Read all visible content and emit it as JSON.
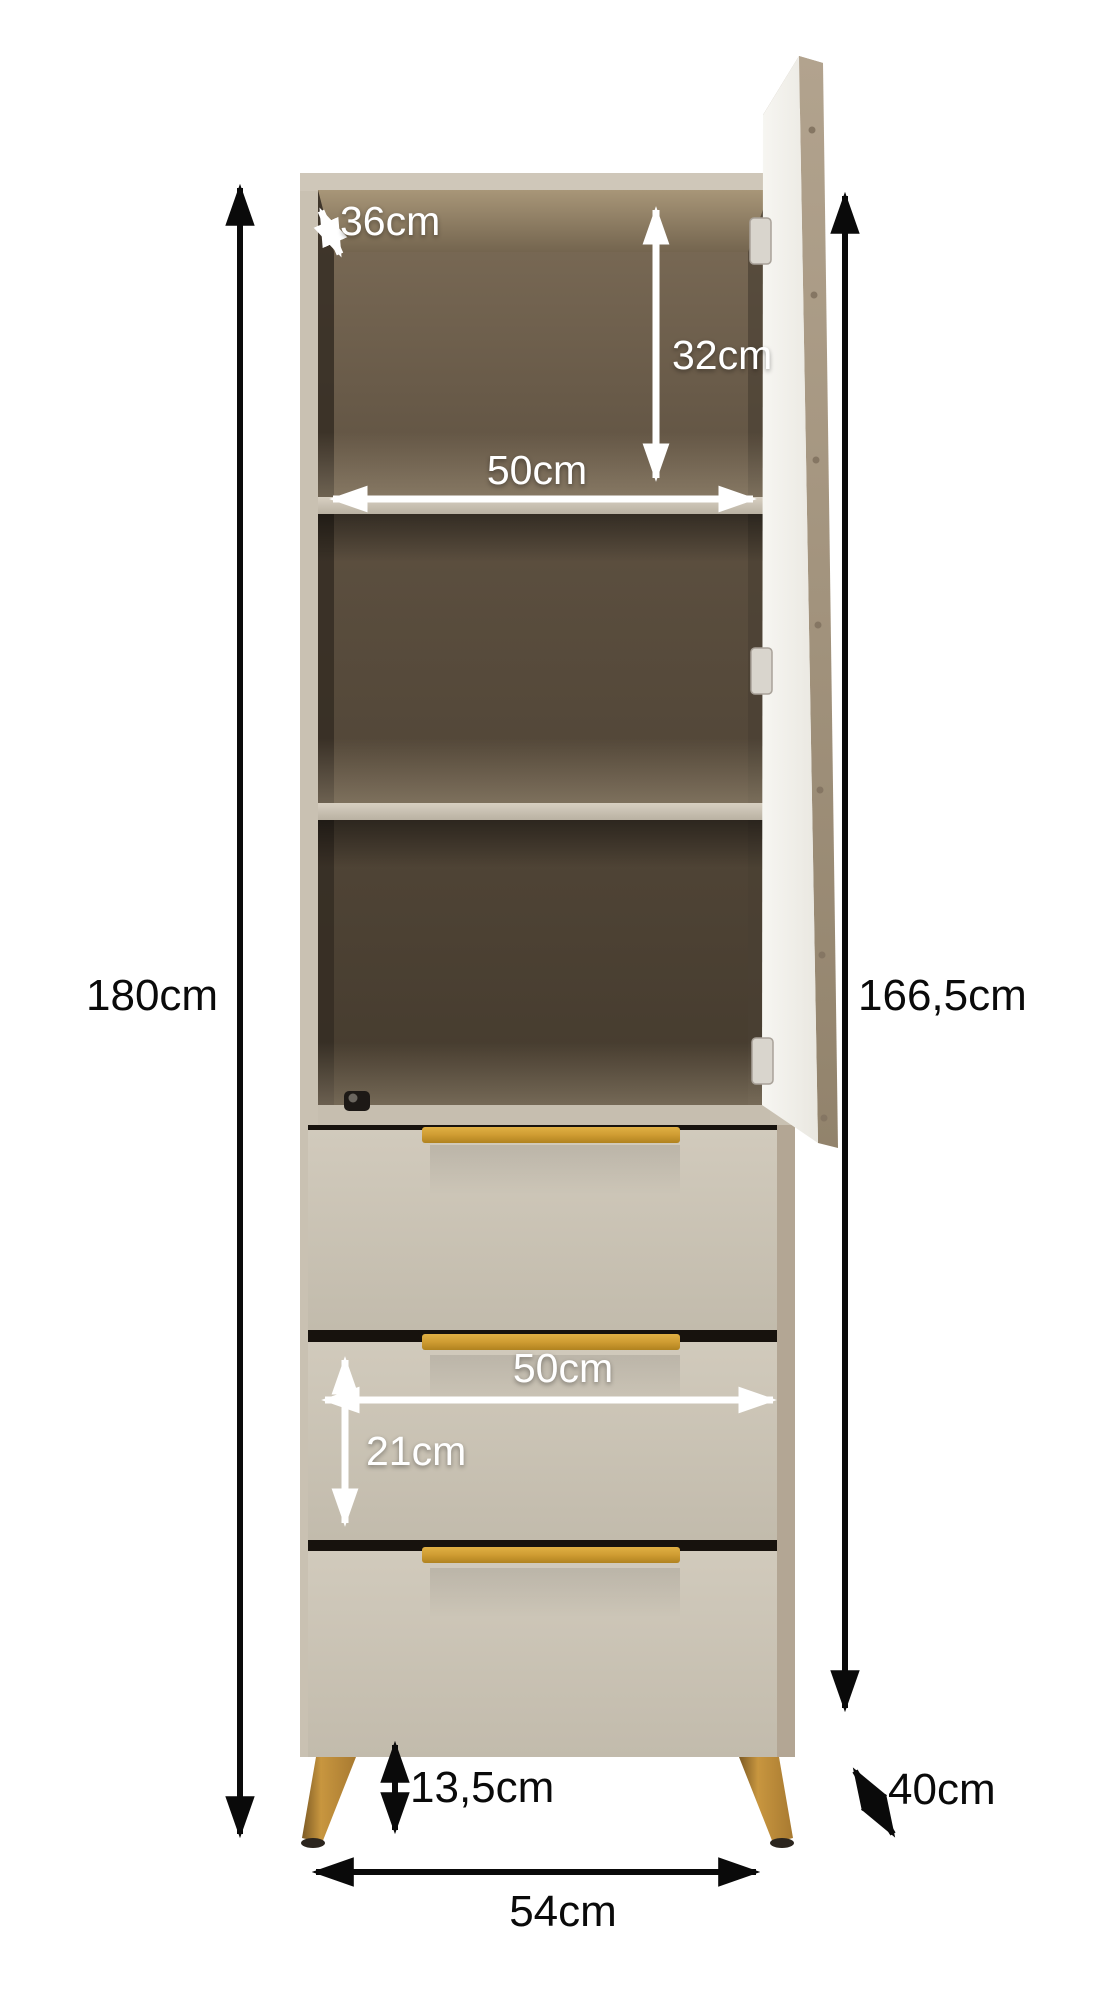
{
  "scene": {
    "description": "Product dimension diagram of a tall cabinet with an open right-hand door, two interior shelves, three drawers with gold handles and angled wooden legs",
    "unit": "cm"
  },
  "dimensions": {
    "top_depth": "36cm",
    "top_compartment_height": "32cm",
    "shelf_width": "50cm",
    "total_height": "180cm",
    "body_height": "166,5cm",
    "drawer_width": "50cm",
    "drawer_front_height": "21cm",
    "leg_height": "13,5cm",
    "depth": "40cm",
    "base_width": "54cm"
  },
  "colors": {
    "background": "#ffffff",
    "dimension-black": "#0a0a0a",
    "dimension-white": "#ffffff",
    "carcass": "#c9c1b2",
    "carcass-top": "#cfc7b9",
    "interior-dark": "#453b2e",
    "interior-mid": "#5d5040",
    "interior-light": "#7d6d58",
    "ceiling": "#a89678",
    "shelf": "#cdc5b7",
    "floor-strip": "#c6beaf",
    "drawer": "#cac2b5",
    "drawer-gap": "#17120d",
    "handle": "#c9992f",
    "door-face": "#f4f3ef",
    "door-edge": "#a99a85",
    "side-panel": "#b3a694",
    "leg": "#c08d3e",
    "hinge": "#d9d5cd",
    "foot": "#2b251e"
  }
}
